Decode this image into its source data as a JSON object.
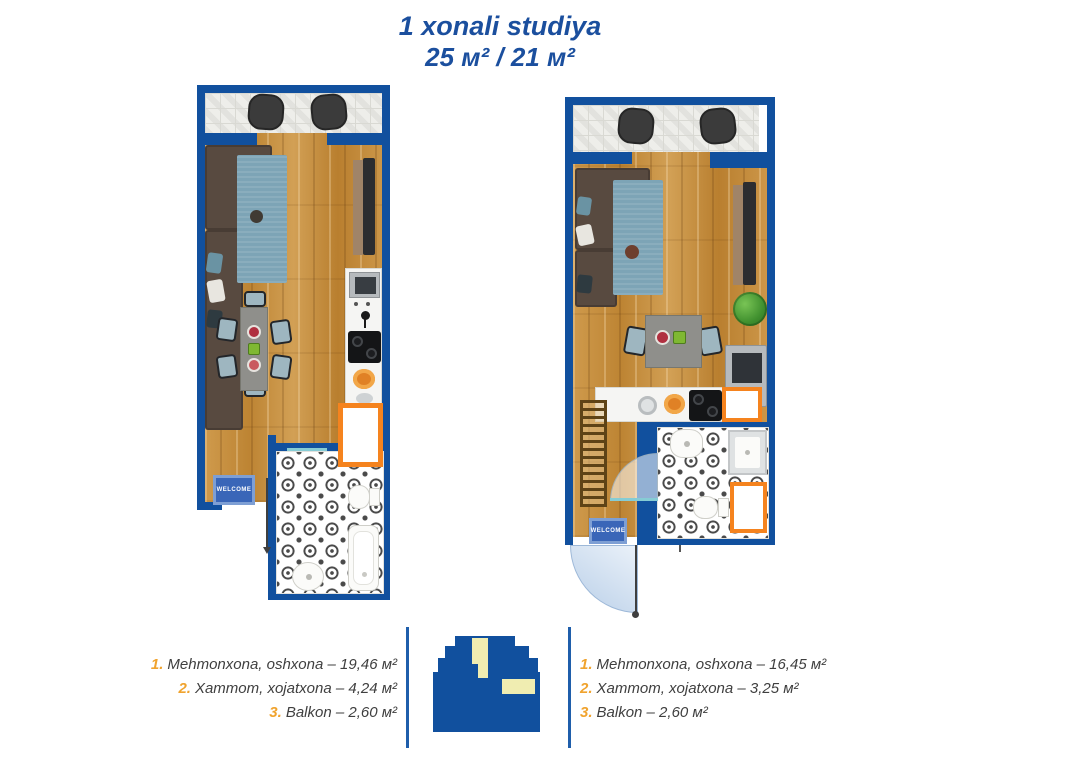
{
  "title": {
    "line1": "1 xonali studiya",
    "line2": "25 м² / 21 м²"
  },
  "plans": {
    "left": {
      "welcome": "WELCOME",
      "legend": [
        {
          "num": "1.",
          "label": "Mehmonxona, oshxona – 19,46 м²"
        },
        {
          "num": "2.",
          "label": "Xammom, xojatxona – 4,24 м²"
        },
        {
          "num": "3.",
          "label": "Balkon – 2,60 м²"
        }
      ]
    },
    "right": {
      "welcome": "WELCOME",
      "legend": [
        {
          "num": "1.",
          "label": "Mehmonxona, oshxona – 16,45 м²"
        },
        {
          "num": "2.",
          "label": "Xammom, xojatxona – 3,25 м²"
        },
        {
          "num": "3.",
          "label": "Balkon – 2,60 м²"
        }
      ]
    }
  },
  "colors": {
    "wall_blue": "#11509e",
    "accent_orange": "#f5831e",
    "title_blue": "#1b4f9e",
    "legend_number": "#f0a32e",
    "legend_text": "#3f3f3f",
    "mat_blue": "#3a66b8"
  }
}
